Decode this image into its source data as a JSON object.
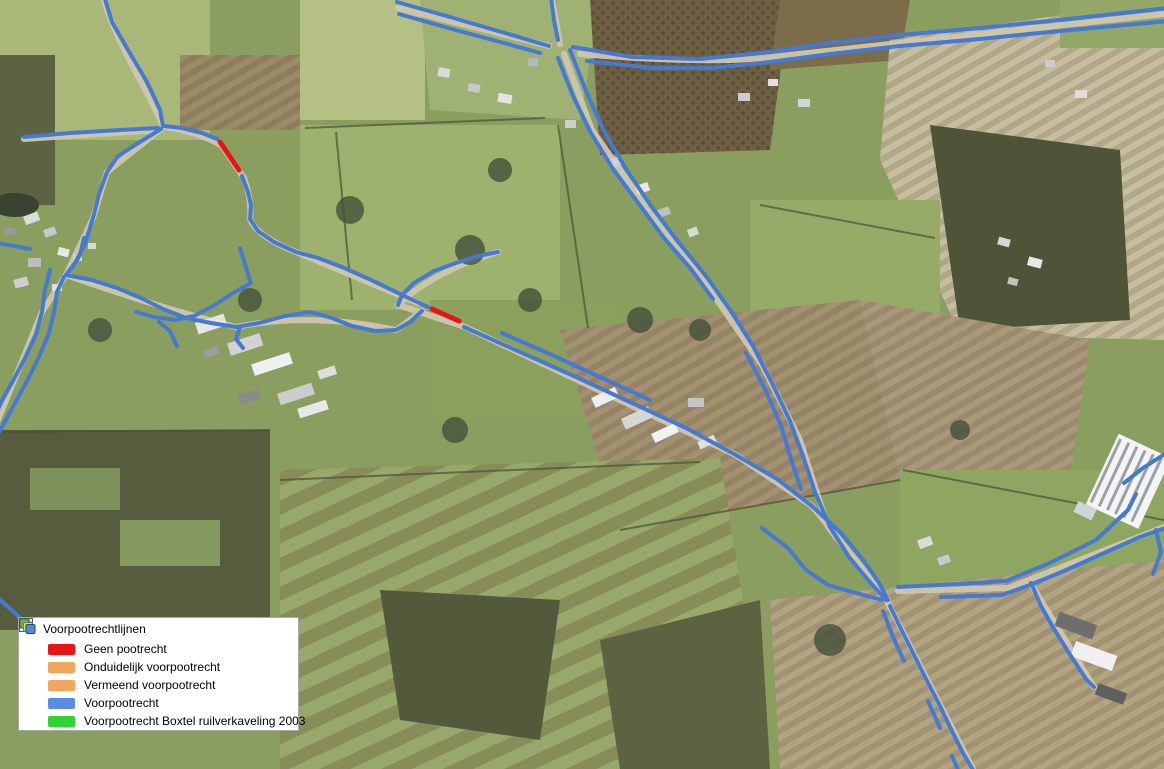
{
  "window": {
    "width": 1164,
    "height": 769,
    "kind": "GIS map view with aerial photo and layer legend"
  },
  "legend": {
    "title": "Voorpootrechtlijnen",
    "expanded": true,
    "checked": true,
    "header_icons": [
      "collapse-minus",
      "checkbox-checked",
      "select-cursor",
      "group-layers"
    ],
    "items": [
      {
        "label": "Geen pootrecht",
        "color": "#e81518"
      },
      {
        "label": "Onduidelijk voorpootrecht",
        "color": "#f2a55c"
      },
      {
        "label": "Vermeend voorpootrecht",
        "color": "#f2a55c"
      },
      {
        "label": "Voorpootrecht",
        "color": "#5b8ce4"
      },
      {
        "label": "Voorpootrecht Boxtel ruilverkaveling 2003",
        "color": "#32d435"
      }
    ]
  },
  "map_layers": {
    "line_width": 4,
    "red_line_width": 5,
    "category_colors": {
      "Voorpootrecht": "#4679d2",
      "Geen pootrecht": "#e81515"
    },
    "lines": [
      {
        "category": "Voorpootrecht",
        "points": [
          [
            104,
            -4
          ],
          [
            112,
            22
          ],
          [
            128,
            50
          ],
          [
            147,
            82
          ],
          [
            160,
            110
          ],
          [
            163,
            126
          ]
        ]
      },
      {
        "category": "Voorpootrecht",
        "points": [
          [
            24,
            137
          ],
          [
            70,
            133
          ],
          [
            120,
            130
          ],
          [
            158,
            128
          ]
        ]
      },
      {
        "category": "Voorpootrecht",
        "points": [
          [
            161,
            129
          ],
          [
            140,
            142
          ],
          [
            118,
            156
          ],
          [
            107,
            172
          ],
          [
            99,
            194
          ],
          [
            93,
            218
          ],
          [
            85,
            244
          ],
          [
            75,
            263
          ],
          [
            66,
            275
          ]
        ]
      },
      {
        "category": "Voorpootrecht",
        "points": [
          [
            164,
            126
          ],
          [
            182,
            128
          ],
          [
            202,
            133
          ],
          [
            217,
            139
          ]
        ]
      },
      {
        "category": "Geen pootrecht",
        "points": [
          [
            220,
            142
          ],
          [
            239,
            170
          ]
        ]
      },
      {
        "category": "Voorpootrecht",
        "points": [
          [
            242,
            176
          ],
          [
            248,
            192
          ],
          [
            251,
            205
          ],
          [
            250,
            219
          ]
        ]
      },
      {
        "category": "Voorpootrecht",
        "points": [
          [
            250,
            219
          ],
          [
            258,
            231
          ],
          [
            274,
            242
          ],
          [
            296,
            252
          ],
          [
            318,
            258
          ],
          [
            342,
            267
          ],
          [
            369,
            279
          ],
          [
            396,
            292
          ],
          [
            417,
            302
          ],
          [
            428,
            307
          ]
        ]
      },
      {
        "category": "Voorpootrecht",
        "points": [
          [
            240,
            248
          ],
          [
            245,
            264
          ],
          [
            250,
            281
          ]
        ]
      },
      {
        "category": "Voorpootrecht",
        "points": [
          [
            251,
            283
          ],
          [
            233,
            293
          ],
          [
            213,
            306
          ],
          [
            194,
            316
          ],
          [
            175,
            320
          ],
          [
            154,
            317
          ],
          [
            136,
            312
          ]
        ]
      },
      {
        "category": "Voorpootrecht",
        "points": [
          [
            66,
            275
          ],
          [
            92,
            280
          ],
          [
            117,
            288
          ],
          [
            141,
            298
          ],
          [
            163,
            309
          ],
          [
            186,
            318
          ],
          [
            211,
            323
          ],
          [
            236,
            327
          ],
          [
            259,
            323
          ],
          [
            285,
            316
          ],
          [
            310,
            312
          ],
          [
            332,
            318
          ],
          [
            352,
            326
          ],
          [
            375,
            331
          ],
          [
            396,
            330
          ],
          [
            410,
            322
          ],
          [
            422,
            311
          ]
        ]
      },
      {
        "category": "Voorpootrecht",
        "points": [
          [
            240,
            327
          ],
          [
            236,
            339
          ],
          [
            243,
            348
          ]
        ]
      },
      {
        "category": "Voorpootrecht",
        "points": [
          [
            159,
            322
          ],
          [
            170,
            331
          ],
          [
            177,
            346
          ]
        ]
      },
      {
        "category": "Voorpootrecht",
        "points": [
          [
            64,
            277
          ],
          [
            57,
            292
          ],
          [
            54,
            312
          ],
          [
            49,
            333
          ],
          [
            39,
            357
          ],
          [
            27,
            381
          ],
          [
            14,
            405
          ],
          [
            2,
            427
          ],
          [
            -4,
            437
          ]
        ]
      },
      {
        "category": "Voorpootrecht",
        "points": [
          [
            50,
            270
          ],
          [
            45,
            290
          ],
          [
            42,
            312
          ],
          [
            36,
            334
          ],
          [
            26,
            356
          ],
          [
            15,
            377
          ],
          [
            4,
            397
          ],
          [
            -4,
            413
          ]
        ]
      },
      {
        "category": "Voorpootrecht",
        "points": [
          [
            84,
            238
          ],
          [
            80,
            255
          ],
          [
            72,
            268
          ]
        ]
      },
      {
        "category": "Voorpootrecht",
        "points": [
          [
            -3,
            243
          ],
          [
            14,
            246
          ],
          [
            30,
            249
          ]
        ]
      },
      {
        "category": "Voorpootrecht",
        "points": [
          [
            -3,
            597
          ],
          [
            16,
            614
          ],
          [
            36,
            634
          ]
        ]
      },
      {
        "category": "Voorpootrecht",
        "points": [
          [
            397,
            2
          ],
          [
            450,
            17
          ],
          [
            505,
            33
          ],
          [
            549,
            46
          ]
        ]
      },
      {
        "category": "Voorpootrecht",
        "points": [
          [
            399,
            14
          ],
          [
            452,
            29
          ],
          [
            504,
            43
          ],
          [
            540,
            53
          ]
        ]
      },
      {
        "category": "Voorpootrecht",
        "points": [
          [
            551,
            -2
          ],
          [
            554,
            20
          ],
          [
            558,
            40
          ]
        ]
      },
      {
        "category": "Voorpootrecht",
        "points": [
          [
            573,
            47
          ],
          [
            632,
            57
          ],
          [
            700,
            59
          ],
          [
            762,
            53
          ],
          [
            830,
            43
          ],
          [
            900,
            35
          ],
          [
            980,
            28
          ],
          [
            1060,
            20
          ],
          [
            1168,
            8
          ]
        ]
      },
      {
        "category": "Voorpootrecht",
        "points": [
          [
            587,
            61
          ],
          [
            652,
            68
          ],
          [
            712,
            68
          ],
          [
            762,
            63
          ],
          [
            830,
            54
          ],
          [
            900,
            46
          ],
          [
            980,
            39
          ],
          [
            1060,
            31
          ],
          [
            1168,
            21
          ]
        ]
      },
      {
        "category": "Voorpootrecht",
        "points": [
          [
            570,
            50
          ],
          [
            586,
            91
          ],
          [
            604,
            131
          ],
          [
            626,
            169
          ],
          [
            651,
            206
          ],
          [
            679,
            243
          ],
          [
            706,
            276
          ],
          [
            731,
            311
          ],
          [
            753,
            346
          ],
          [
            772,
            383
          ],
          [
            790,
            421
          ],
          [
            803,
            456
          ],
          [
            815,
            492
          ],
          [
            830,
            527
          ],
          [
            849,
            557
          ],
          [
            869,
            581
          ],
          [
            886,
            600
          ]
        ]
      },
      {
        "category": "Voorpootrecht",
        "points": [
          [
            558,
            58
          ],
          [
            573,
            96
          ],
          [
            591,
            133
          ],
          [
            613,
            169
          ],
          [
            639,
            204
          ],
          [
            664,
            238
          ],
          [
            691,
            269
          ],
          [
            713,
            299
          ]
        ]
      },
      {
        "category": "Voorpootrecht",
        "points": [
          [
            746,
            353
          ],
          [
            766,
            391
          ],
          [
            781,
            426
          ],
          [
            791,
            459
          ],
          [
            801,
            489
          ]
        ]
      },
      {
        "category": "Voorpootrecht",
        "points": [
          [
            498,
            252
          ],
          [
            478,
            256
          ],
          [
            456,
            263
          ],
          [
            434,
            271
          ],
          [
            414,
            283
          ],
          [
            402,
            295
          ],
          [
            398,
            305
          ]
        ]
      },
      {
        "category": "Geen pootrecht",
        "points": [
          [
            432,
            309
          ],
          [
            459,
            321
          ]
        ]
      },
      {
        "category": "Voorpootrecht",
        "points": [
          [
            464,
            327
          ],
          [
            520,
            352
          ],
          [
            576,
            377
          ],
          [
            632,
            403
          ],
          [
            686,
            428
          ],
          [
            736,
            455
          ],
          [
            777,
            479
          ],
          [
            812,
            506
          ],
          [
            842,
            534
          ],
          [
            864,
            561
          ],
          [
            879,
            583
          ],
          [
            888,
            600
          ]
        ]
      },
      {
        "category": "Voorpootrecht",
        "points": [
          [
            502,
            333
          ],
          [
            552,
            355
          ],
          [
            602,
            378
          ],
          [
            650,
            400
          ]
        ]
      },
      {
        "category": "Voorpootrecht",
        "points": [
          [
            762,
            528
          ],
          [
            788,
            548
          ],
          [
            806,
            570
          ],
          [
            828,
            585
          ],
          [
            856,
            593
          ],
          [
            882,
            600
          ]
        ]
      },
      {
        "category": "Voorpootrecht",
        "points": [
          [
            898,
            587
          ],
          [
            960,
            584
          ],
          [
            1006,
            581
          ],
          [
            1052,
            562
          ],
          [
            1096,
            540
          ],
          [
            1128,
            510
          ],
          [
            1136,
            494
          ]
        ]
      },
      {
        "category": "Voorpootrecht",
        "points": [
          [
            941,
            597
          ],
          [
            1002,
            595
          ],
          [
            1030,
            585
          ],
          [
            1064,
            571
          ],
          [
            1104,
            553
          ],
          [
            1140,
            537
          ],
          [
            1168,
            527
          ]
        ]
      },
      {
        "category": "Voorpootrecht",
        "points": [
          [
            1031,
            583
          ],
          [
            1041,
            606
          ],
          [
            1054,
            629
          ],
          [
            1069,
            653
          ],
          [
            1086,
            679
          ],
          [
            1094,
            687
          ]
        ]
      },
      {
        "category": "Voorpootrecht",
        "points": [
          [
            1168,
            452
          ],
          [
            1143,
            468
          ],
          [
            1124,
            483
          ]
        ]
      },
      {
        "category": "Voorpootrecht",
        "points": [
          [
            1156,
            530
          ],
          [
            1161,
            552
          ],
          [
            1153,
            574
          ]
        ]
      },
      {
        "category": "Voorpootrecht",
        "points": [
          [
            890,
            606
          ],
          [
            901,
            629
          ],
          [
            913,
            653
          ],
          [
            926,
            679
          ],
          [
            939,
            704
          ],
          [
            951,
            729
          ],
          [
            963,
            753
          ],
          [
            973,
            770
          ]
        ]
      },
      {
        "category": "Voorpootrecht",
        "points": [
          [
            883,
            611
          ],
          [
            893,
            637
          ],
          [
            904,
            661
          ]
        ]
      },
      {
        "category": "Voorpootrecht",
        "points": [
          [
            928,
            701
          ],
          [
            940,
            728
          ]
        ]
      },
      {
        "category": "Voorpootrecht",
        "points": [
          [
            952,
            756
          ],
          [
            958,
            770
          ]
        ]
      }
    ]
  }
}
